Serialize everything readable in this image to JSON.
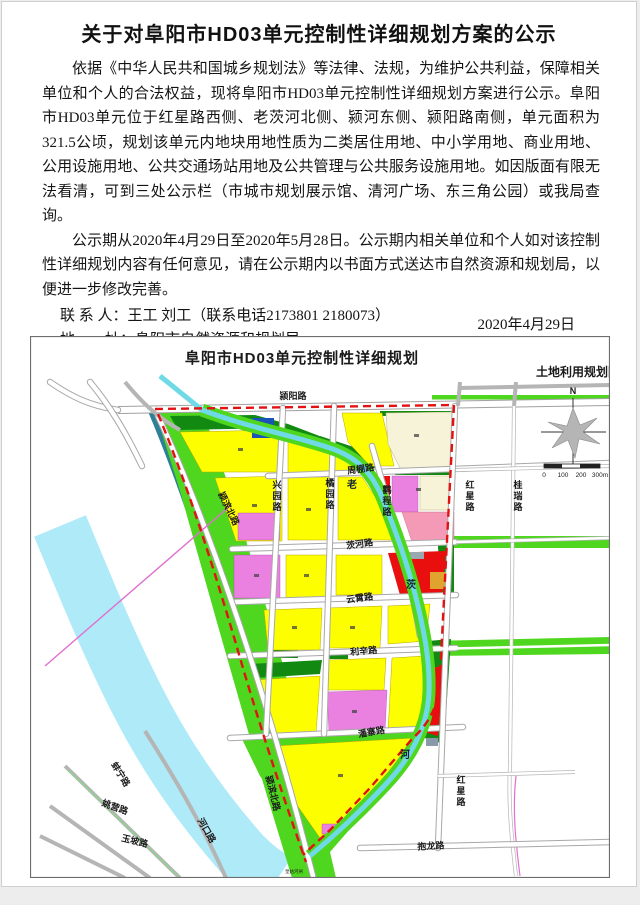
{
  "notice": {
    "title": "关于对阜阳市HD03单元控制性详细规划方案的公示",
    "paragraphs": [
      "依据《中华人民共和国城乡规划法》等法律、法规，为维护公共利益，保障相关单位和个人的合法权益，现将阜阳市HD03单元控制性详细规划方案进行公示。阜阳市HD03单元位于红星路西侧、老茨河北侧、颍河东侧、颍阳路南侧，单元面积为321.5公顷，规划该单元内地块用地性质为二类居住用地、中小学用地、商业用地、公用设施用地、公共交通场站用地及公共管理与公共服务设施用地。如因版面有限无法看清，可到三处公示栏（市城市规划展示馆、清河广场、东三角公园）或我局查询。",
      "公示期从2020年4月29日至2020年5月28日。公示期内相关单位和个人如对该控制性详细规划内容有任何意见，请在公示期内以书面方式送达市自然资源和规划局，以便进一步修改完善。"
    ],
    "contacts": [
      {
        "label": "联 系 人：",
        "value": "王工 刘工（联系电话2173801 2180073）"
      },
      {
        "label": "地　　址：",
        "value": "阜阳市自然资源和规划局"
      },
      {
        "label": "登陆网站：",
        "value": "http://zrgh.fy.gov.cn/"
      }
    ],
    "date": "2020年4月29日"
  },
  "map": {
    "title": "阜阳市HD03单元控制性详细规划",
    "subtitle": "土地利用规划图",
    "north_label": "N",
    "scale_labels": [
      "0",
      "100",
      "200",
      "300m"
    ],
    "labels": [
      {
        "t": "颍阳路"
      },
      {
        "t": "周棚路"
      },
      {
        "t": "茨河路"
      },
      {
        "t": "云霄路"
      },
      {
        "t": "利辛路"
      },
      {
        "t": "潘寨路"
      },
      {
        "t": "抱龙路"
      },
      {
        "t": "颍滨北路"
      },
      {
        "t": "颍滨北路"
      },
      {
        "t": "兴园路"
      },
      {
        "t": "橘园路"
      },
      {
        "t": "鹳程路"
      },
      {
        "t": "红星路"
      },
      {
        "t": "红星路"
      },
      {
        "t": "桂瑞路"
      },
      {
        "t": "老"
      },
      {
        "t": "茨"
      },
      {
        "t": "河"
      },
      {
        "t": "蚌宁路"
      },
      {
        "t": "姚营路"
      },
      {
        "t": "玉坡路"
      },
      {
        "t": "河口路"
      },
      {
        "t": "皇姑河闸"
      }
    ],
    "colors": {
      "residential_yellow": "#fdff00",
      "park_green": "#4fd61e",
      "protective_green": "#128a12",
      "school_magenta": "#ea80e0",
      "medical_pink": "#f59ab6",
      "commercial_red": "#e90f0f",
      "utility_blue": "#1b52b8",
      "transit_orange": "#dfa32e",
      "reserved_cream": "#f7f3d8",
      "river_blue": "#aeeaf8",
      "stream_cyan": "#6fd9e6",
      "embankment_teal": "#2e8097",
      "boundary_red": "#e31212"
    }
  }
}
